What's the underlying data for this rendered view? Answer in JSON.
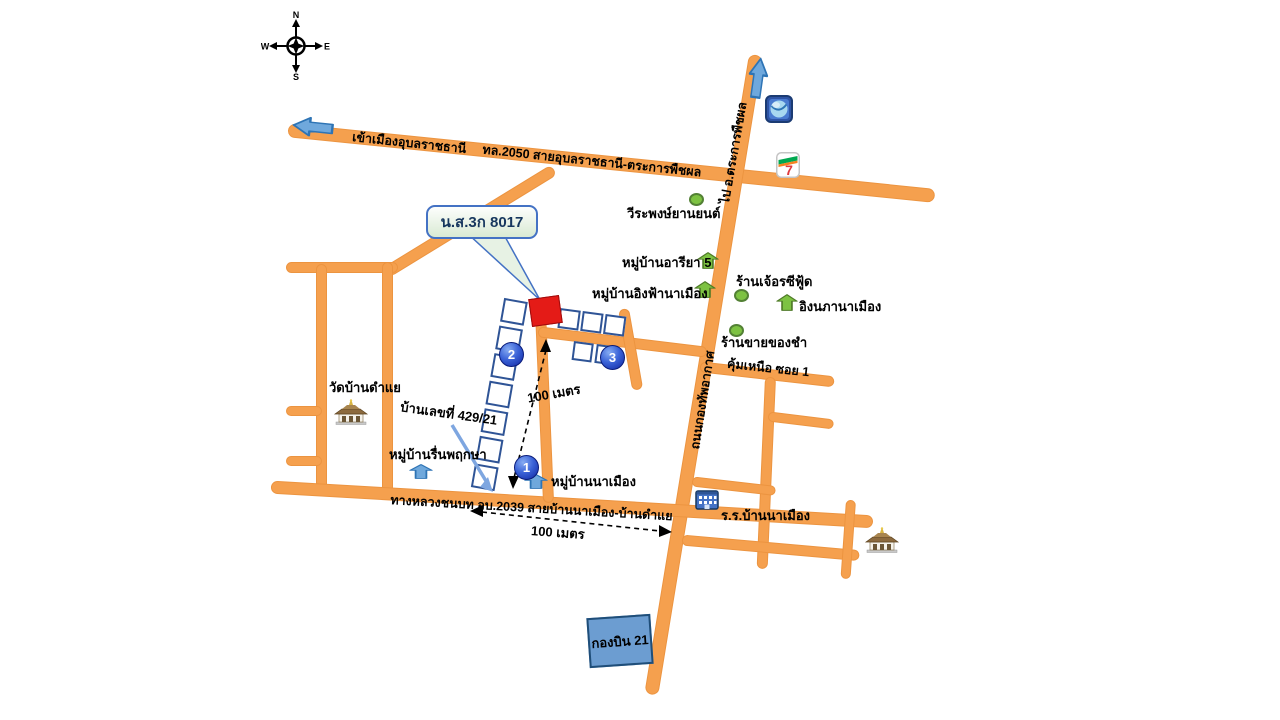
{
  "compass": {
    "n": "N",
    "e": "E",
    "s": "S",
    "w": "W"
  },
  "callout": {
    "label": "น.ส.3ก 8017"
  },
  "roads": {
    "into_city": "เข้าเมืองอุบลราชธานี",
    "hwy2050": "ทล.2050 สายอุบลราชธานี-ตระการพืชผล",
    "to_trakan": "ไป อ.ตระการพืชผล",
    "airforce": "ถนนกองทัพอากาศ",
    "rural2039": "ทางหลวงชนบท อบ.2039 สายบ้านนาเมือง-บ้านดำแย",
    "soi_nuea": "คุ้มเหนือ ซอย 1"
  },
  "places": {
    "car_shop": "วีระพงษ์ยานยนต์",
    "areeya": "หมู่บ้านอารียา 5",
    "ingfah": "หมู่บ้านอิงฟ้านาเมือง",
    "seafood": "ร้านเจ้อรซีฟู้ด",
    "ingnapha": "อิงนภานาเมือง",
    "grocery": "ร้านขายของชำ",
    "temple": "วัดบ้านดำแย",
    "house_no": "บ้านเลขที่ 429/21",
    "ruenpruksa": "หมู่บ้านรื่นพฤกษา",
    "namueang": "หมู่บ้านนาเมือง",
    "school": "ร.ร.บ้านนาเมือง",
    "wing21": "กองบิน 21"
  },
  "measures": {
    "v": "100 เมตร",
    "h": "100 เมตร"
  },
  "markers": {
    "m1": "1",
    "m2": "2",
    "m3": "3"
  },
  "logos": {
    "seven": "7"
  },
  "colors": {
    "road": "#F5A04E",
    "parcel_red": "#E41B17",
    "marker_blue": "#1C39BB",
    "arrow_green": "#7DC242",
    "arrow_blue": "#6FA8DC",
    "callout_border": "#4472C4",
    "wing_fill": "#6C9DD1"
  }
}
